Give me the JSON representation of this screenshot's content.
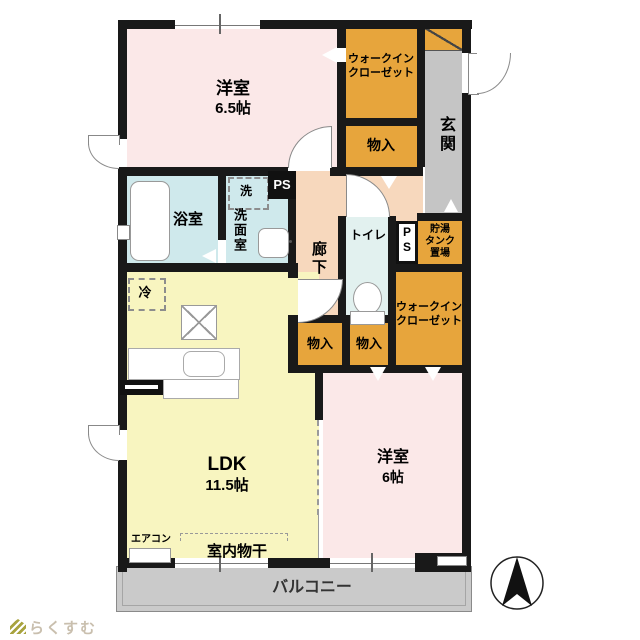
{
  "plan": {
    "rooms": {
      "bedroom_65": {
        "name": "洋室",
        "size": "6.5帖"
      },
      "wic_top": {
        "line1": "ウォークイン",
        "line2": "クローゼット"
      },
      "storage_top": {
        "label": "物入"
      },
      "entrance": {
        "label": "玄関"
      },
      "bathroom": {
        "label": "浴室"
      },
      "washroom": {
        "label": "洗面室",
        "washer": "洗"
      },
      "hallway": {
        "label": "廊下"
      },
      "toilet": {
        "label": "トイレ"
      },
      "ps_upper": {
        "label": "PS"
      },
      "ps_lower": {
        "line1": "P",
        "line2": "S"
      },
      "tank": {
        "line1": "貯湯",
        "line2": "タンク",
        "line3": "置場"
      },
      "wic_mid": {
        "line1": "ウォークイン",
        "line2": "クローゼット"
      },
      "storage_left": {
        "label": "物入"
      },
      "storage_right": {
        "label": "物入"
      },
      "fridge": {
        "label": "冷"
      },
      "ldk": {
        "name": "LDK",
        "size": "11.5帖"
      },
      "bedroom_6": {
        "name": "洋室",
        "size": "6帖"
      },
      "aircon": {
        "label": "エアコン"
      },
      "drying": {
        "label": "室内物干"
      },
      "balcony": {
        "label": "バルコニー"
      }
    },
    "branding": {
      "logo_text": "らくすむ"
    },
    "colors": {
      "wall": "#191919",
      "pink": "#fbe8e8",
      "orange": "#e7a53c",
      "yellow": "#f8f5c0",
      "peach": "#f7d8bd",
      "bath_blue": "#cfe9ec",
      "toilet_blue": "#e2f1ef",
      "gray": "#c5c5c5",
      "balcony_gray": "#cacaca"
    }
  }
}
